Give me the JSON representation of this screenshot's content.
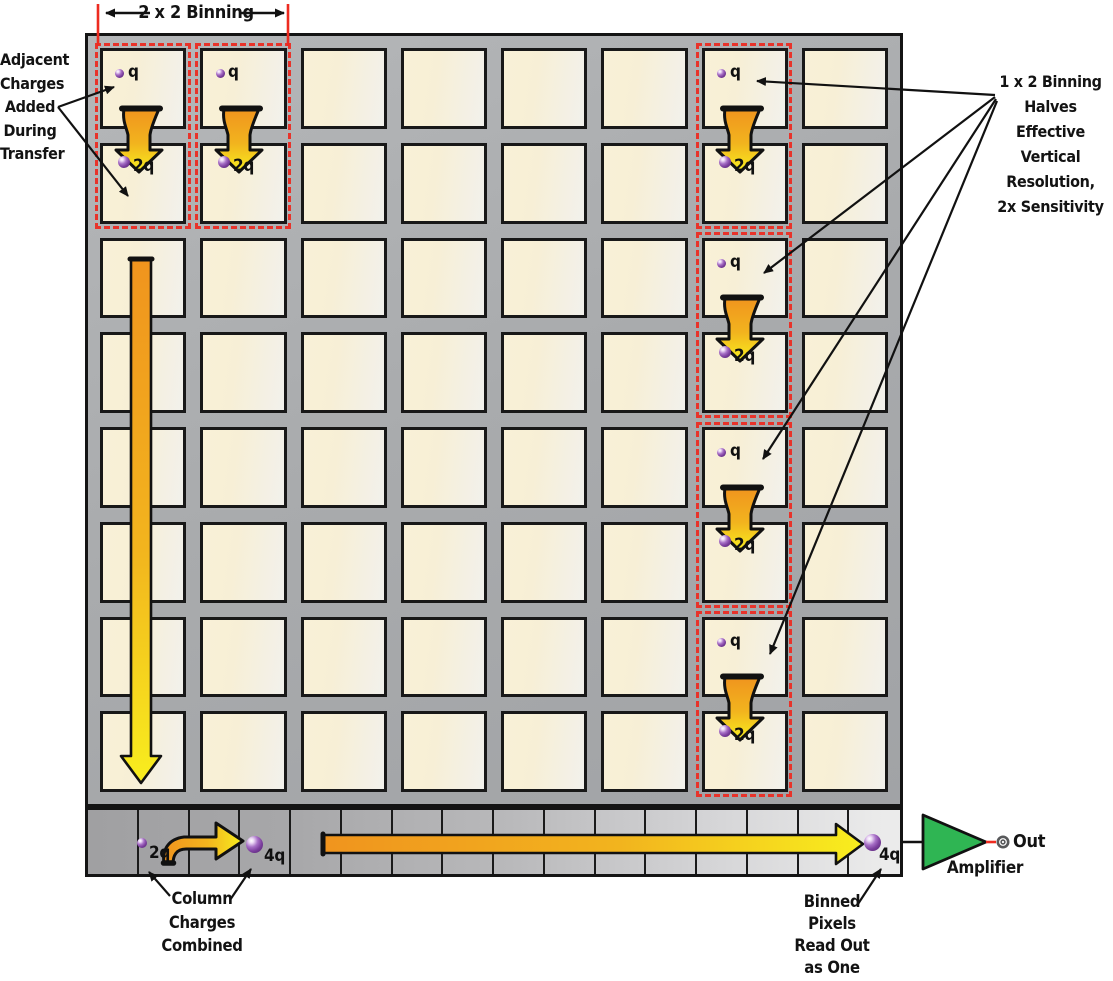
{
  "title_labels": {
    "top": "2 x 2 Binning",
    "left": "Adjacent\nCharges\nAdded\nDuring\nTransfer",
    "right": "1 x 2 Binning\nHalves Effective\nVertical Resolution,\n2x Sensitivity",
    "column": "Column\nCharges\nCombined",
    "binned": "Binned\nPixels\nRead Out\nas One",
    "amplifier": "Amplifier",
    "out": "Out"
  },
  "charges": {
    "unit": "q",
    "double": "2q",
    "quad": "4q"
  },
  "grid": {
    "columns": 8,
    "rows": 8,
    "register_cells": 16
  },
  "colors": {
    "highlight_red": "#e8332a",
    "arrow_orange": "#f0941e",
    "arrow_yellow": "#f8ee1e",
    "amplifier_green": "#2fb553",
    "charge_purple": "#7c3f9e",
    "chip_gray": "#a9abad",
    "pixel_cream": "#f8f0d8"
  },
  "icons": {
    "transfer_arrow": "bent-down-arrow",
    "readout_arrow": "bent-right-arrow",
    "column_shift_arrow": "long-down-arrow",
    "serial_shift_arrow": "long-right-arrow",
    "amplifier_symbol": "green-triangle-right",
    "output_terminal": "ring-connector",
    "charge_marker": "purple-sphere"
  }
}
